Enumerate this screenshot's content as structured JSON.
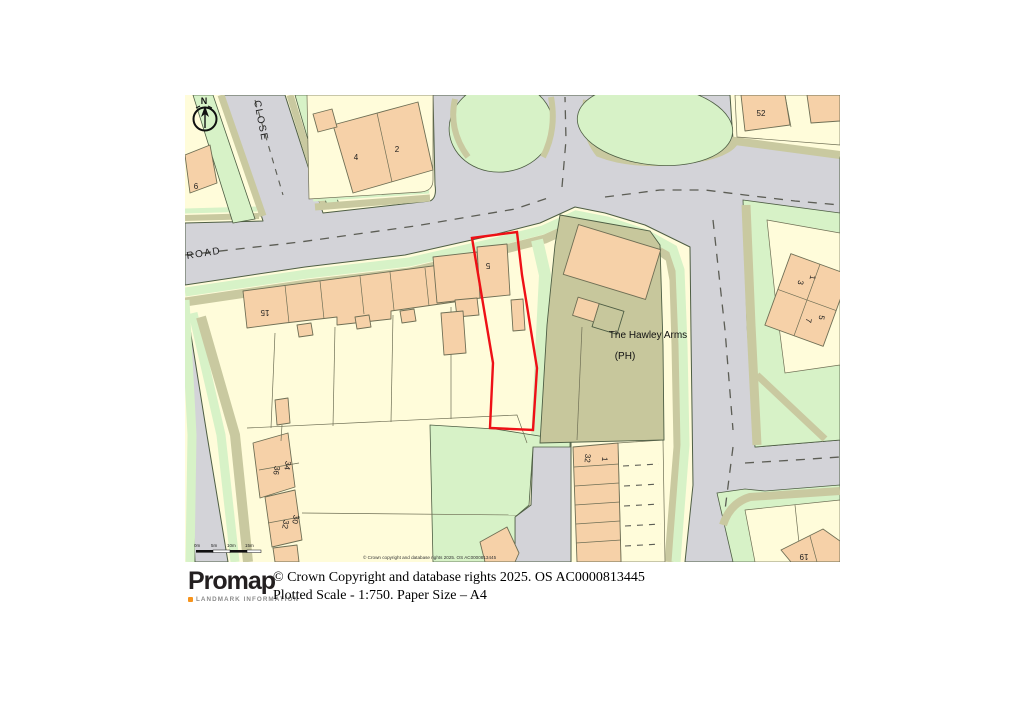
{
  "map": {
    "labels": {
      "north": "N",
      "close_street": "CLOSE",
      "road_street": "ROAD",
      "pub_name": "The Hawley Arms",
      "pub_type": "(PH)",
      "h6": "6",
      "h4": "4",
      "h2": "2",
      "h52": "52",
      "h15": "15",
      "h5": "5",
      "r1": "1",
      "r3": "3",
      "r5": "5",
      "r7": "7",
      "h34": "34",
      "h36": "36",
      "h30": "30",
      "h32": "32",
      "g32": "32",
      "g1": "1",
      "h19": "19",
      "copyright": "© Crown copyright and database rights 2025. OS AC0000813445"
    },
    "scalebar": {
      "labels": [
        "0m",
        "5m",
        "10m",
        "15m"
      ]
    }
  },
  "footer": {
    "logo": "Promap",
    "logo_sub": "LANDMARK INFORMATION",
    "copyright": "© Crown Copyright and database rights 2025. OS AC0000813445",
    "scale_line": "Plotted Scale - 1:750. Paper Size – A4"
  },
  "colors": {
    "road": "#d3d3d8",
    "green": "#d7f2c7",
    "khaki": "#c9c9a0",
    "pub_plot": "#c7c79c",
    "parcel": "#fffcda",
    "building": "#f6d1a8",
    "outline": "#4e5e44",
    "building_outline": "#6f6f55",
    "plot_outline": "#ee1016",
    "dash": "#5c5d55",
    "text": "#1c1c1c"
  }
}
